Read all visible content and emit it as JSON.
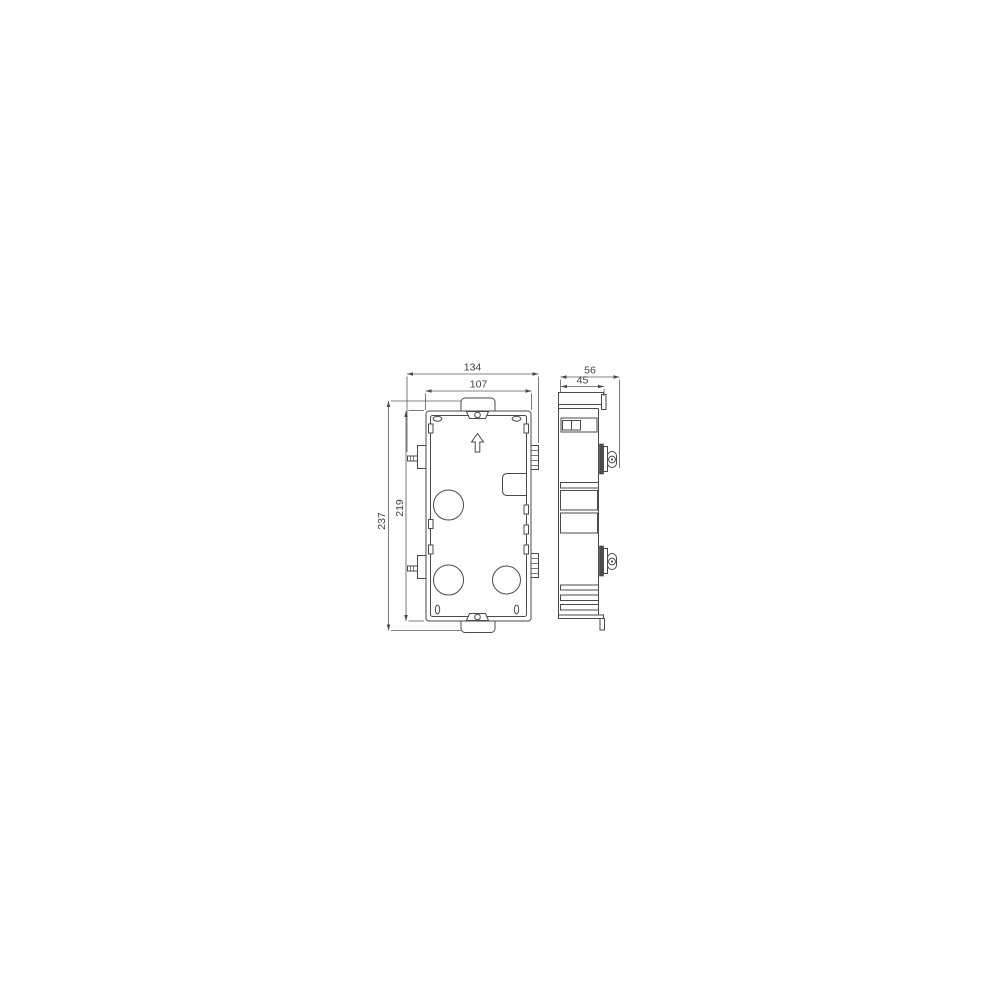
{
  "drawing": {
    "type": "technical-dimension-drawing",
    "subject": "flush-mount gang box, front view and side view",
    "colors": {
      "background": "#ffffff",
      "line": "#4a4a4a",
      "text": "#3f3f3f"
    },
    "dims": {
      "front_overall_width": "134",
      "front_inner_width": "107",
      "front_overall_height": "237",
      "front_inner_height": "219",
      "side_overall_depth": "56",
      "side_inner_depth": "45"
    }
  }
}
